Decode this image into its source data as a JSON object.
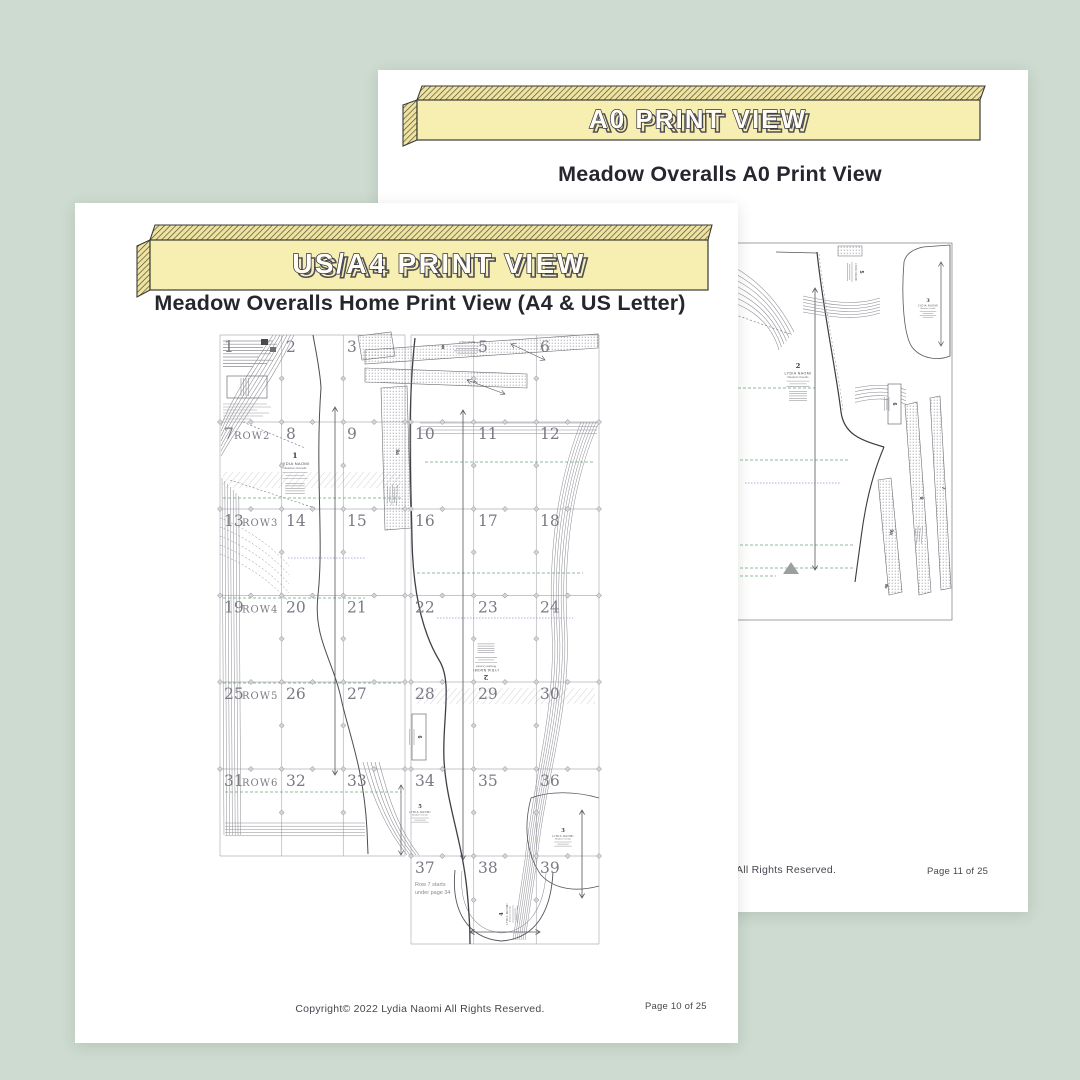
{
  "colors": {
    "background": "#cddbd0",
    "page": "#ffffff",
    "banner_fill": "#f7efb2",
    "banner_hatch_bg": "#eee3a0",
    "banner_edge": "#3a3a35",
    "banner_text_fill": "#fffdf4",
    "banner_text_outline": "#333346",
    "heading_ink": "#26262e",
    "footer_ink": "#47474f",
    "grid_line": "#b3b3b8",
    "tile_number": "#7a7a84",
    "pattern_light": "#8b8b93",
    "pattern_dark": "#3f3f46",
    "accent_green": "#71a37e",
    "accent_blue": "#8b97cf"
  },
  "back_page": {
    "banner": "A0 PRINT VIEW",
    "title": "Meadow Overalls A0 Print View",
    "footer_left": "All Rights Reserved.",
    "footer_right": "Page 11 of 25",
    "brand": "LYDIA NAOMI",
    "piece_subtitle": "Meadow Overalls",
    "pieces": {
      "p2": "2",
      "p3": "3",
      "p5": "5",
      "p6": "6",
      "p7": "7",
      "p8": "8",
      "p9a": "9a",
      "p9b": "9b"
    }
  },
  "front_page": {
    "banner": "US/A4 PRINT VIEW",
    "title": "Meadow Overalls Home Print View (A4 & US Letter)",
    "footer_left": "Copyright© 2022  Lydia Naomi  All Rights Reserved.",
    "footer_right": "Page 10 of 25",
    "brand": "LYDIA NAOMI",
    "piece_subtitle": "Meadow Overalls",
    "row_note": [
      "Row 7 starts",
      "under page 34"
    ],
    "grid": {
      "r1": [
        "1",
        "2",
        "3",
        "5",
        "6"
      ],
      "r2": [
        "7",
        "8",
        "9",
        "10",
        "11",
        "12"
      ],
      "r3": [
        "13",
        "14",
        "15",
        "16",
        "17",
        "18"
      ],
      "r4": [
        "19",
        "20",
        "21",
        "22",
        "23",
        "24"
      ],
      "r5": [
        "25",
        "26",
        "27",
        "28",
        "29",
        "30"
      ],
      "r6": [
        "31",
        "32",
        "33",
        "34",
        "35",
        "36"
      ],
      "r7": [
        "37",
        "38",
        "39"
      ],
      "row_labels": [
        "ROW2",
        "ROW3",
        "ROW4",
        "ROW5",
        "ROW6"
      ]
    },
    "pieces": {
      "p1": "1",
      "p2": "2",
      "p3": "3",
      "p4": "4",
      "p5": "5",
      "p6": "6",
      "p7": "7",
      "p8": "8",
      "p9a": "9a"
    }
  }
}
